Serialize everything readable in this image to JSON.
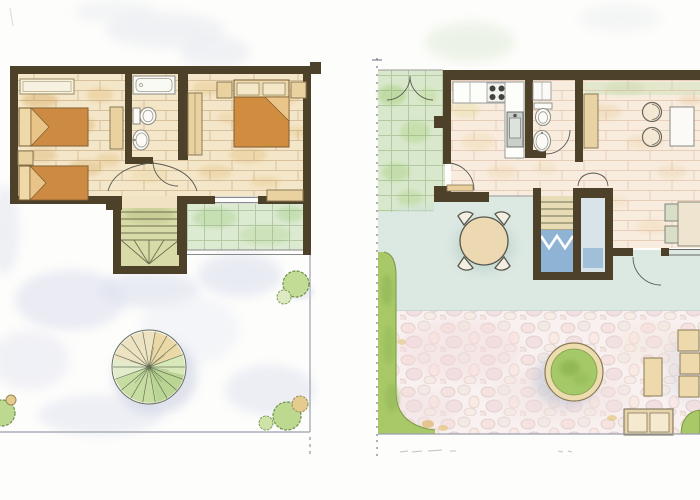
{
  "document": {
    "title": "Watercolor floor plans of a two-storey holiday house",
    "type": "hand-drawn architectural plan, top view",
    "pencil_marks": "illegible pencil scribbles below ground-floor plan"
  },
  "palette": {
    "wall": "#4d4129",
    "floor_tan": "#f4e6c8",
    "floor_pink": "#f8ecdf",
    "tile_green": "#d9e8cc",
    "tile_blue": "#dce8e2",
    "pebble": "#f8f1f0",
    "grass": "#a9c968",
    "bed_orange": "#cd8a42",
    "furniture_tan": "#e9d2a0",
    "fixture_white": "#fbfaf6",
    "stair_green": "#d8daa8",
    "water_blue": "#8fb3d4",
    "tree_green": "#a9cc7d",
    "shadow_lavender": "#dfe2ef"
  },
  "plans": {
    "upper": {
      "label": "Upper floor plan with roof terrace",
      "rooms": [
        {
          "name": "Twin bedroom",
          "furniture": [
            "single bed",
            "single bed",
            "bench",
            "nightstand",
            "cabinet"
          ]
        },
        {
          "name": "Bathroom",
          "furniture": [
            "bathtub",
            "toilet",
            "washbasin"
          ]
        },
        {
          "name": "Double bedroom",
          "furniture": [
            "double bed",
            "nightstand",
            "nightstand",
            "wardrobe",
            "bench"
          ]
        },
        {
          "name": "Hall",
          "furniture": [
            "staircase",
            "doors"
          ]
        },
        {
          "name": "Balcony",
          "furniture": []
        },
        {
          "name": "Roof terrace",
          "furniture": [
            "large tree",
            "shrubs"
          ]
        }
      ]
    },
    "ground": {
      "label": "Ground floor plan with garden",
      "rooms": [
        {
          "name": "Kitchen",
          "furniture": [
            "counter",
            "stove",
            "sink"
          ]
        },
        {
          "name": "Bathroom",
          "furniture": [
            "toilet",
            "washbasin",
            "shelf"
          ]
        },
        {
          "name": "Living room",
          "furniture": [
            "sideboard",
            "armchair",
            "armchair",
            "coffee table",
            "dining table",
            "chairs",
            "closet",
            "staircase"
          ]
        },
        {
          "name": "Patio",
          "furniture": [
            "round table",
            "four chairs"
          ]
        },
        {
          "name": "Garden",
          "furniture": [
            "lawn strip",
            "round planter",
            "loungers",
            "side table",
            "garden bench",
            "shrubs"
          ]
        }
      ]
    }
  }
}
